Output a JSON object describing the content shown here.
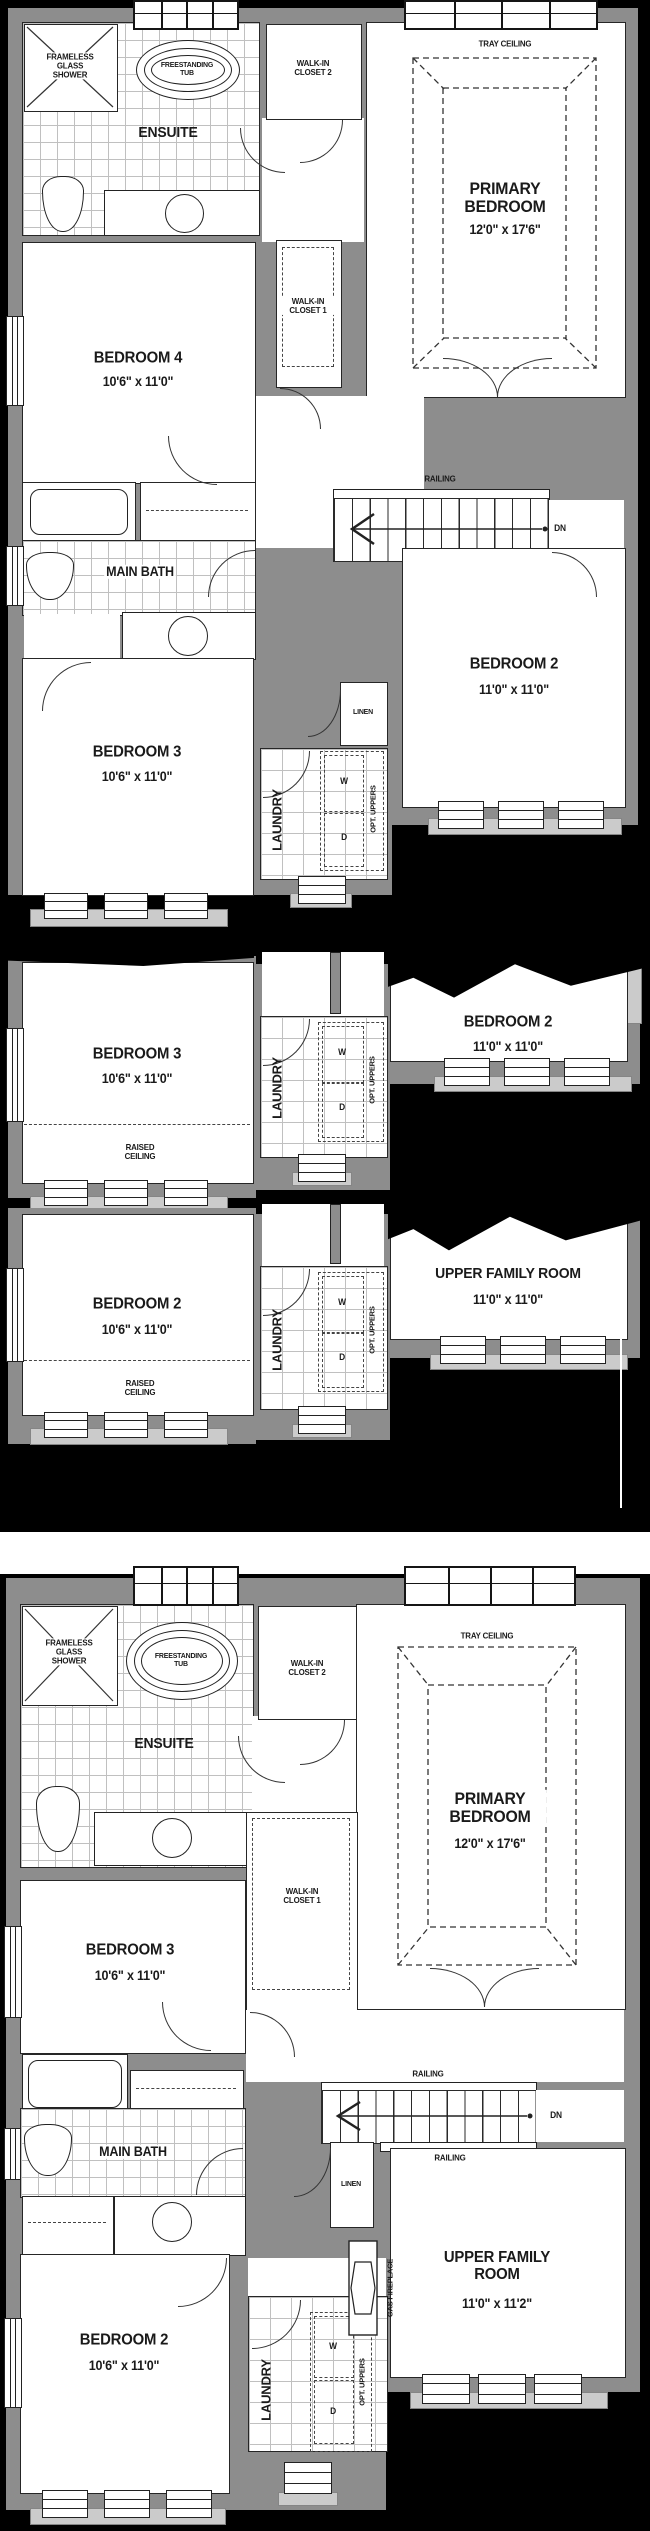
{
  "colors": {
    "background": "#000000",
    "wall": "#8d8d8d",
    "sill": "#cbcbcb",
    "floor": "#ffffff",
    "line": "#262626"
  },
  "plans": {
    "p1": {
      "ensuite": "ENSUITE",
      "shower": "FRAMELESS GLASS SHOWER",
      "tub": "FREESTANDING TUB",
      "wic2": "WALK-IN CLOSET 2",
      "wic1": "WALK-IN CLOSET 1",
      "tray": "TRAY CEILING",
      "primary": "PRIMARY BEDROOM",
      "primary_dim": "12'0\" x 17'6\"",
      "bed4": "BEDROOM 4",
      "bed4_dim": "10'6\" x 11'0\"",
      "main_bath": "MAIN BATH",
      "railing": "RAILING",
      "dn": "DN",
      "bed2": "BEDROOM 2",
      "bed2_dim": "11'0\" x 11'0\"",
      "bed3": "BEDROOM 3",
      "bed3_dim": "10'6\" x 11'0\"",
      "linen": "LINEN",
      "laundry": "LAUNDRY",
      "washer": "W",
      "dryer": "D",
      "opt_uppers": "OPT. UPPERS"
    },
    "p2": {
      "bed3": "BEDROOM 3",
      "bed3_dim": "10'6\" x 11'0\"",
      "raised": "RAISED CEILING",
      "laundry": "LAUNDRY",
      "washer": "W",
      "dryer": "D",
      "opt_uppers": "OPT. UPPERS",
      "bed2": "BEDROOM 2",
      "bed2_dim": "11'0\" x 11'0\""
    },
    "p3": {
      "bed2": "BEDROOM 2",
      "bed2_dim": "10'6\" x 11'0\"",
      "raised": "RAISED CEILING",
      "laundry": "LAUNDRY",
      "washer": "W",
      "dryer": "D",
      "opt_uppers": "OPT. UPPERS",
      "ufr": "UPPER FAMILY ROOM",
      "ufr_dim": "11'0\" x 11'0\""
    },
    "p4": {
      "ensuite": "ENSUITE",
      "shower": "FRAMELESS GLASS SHOWER",
      "tub": "FREESTANDING TUB",
      "wic2": "WALK-IN CLOSET 2",
      "wic1": "WALK-IN CLOSET 1",
      "tray": "TRAY CEILING",
      "primary": "PRIMARY BEDROOM",
      "primary_dim": "12'0\" x 17'6\"",
      "bed3": "BEDROOM 3",
      "bed3_dim": "10'6\" x 11'0\"",
      "main_bath": "MAIN BATH",
      "railing_top": "RAILING",
      "railing_bottom": "RAILING",
      "dn": "DN",
      "linen": "LINEN",
      "gas_fireplace": "GAS FIREPLACE",
      "ufr": "UPPER FAMILY ROOM",
      "ufr_dim": "11'0\" x 11'2\"",
      "bed2": "BEDROOM 2",
      "bed2_dim": "10'6\" x 11'0\"",
      "laundry": "LAUNDRY",
      "washer": "W",
      "dryer": "D",
      "opt_uppers": "OPT. UPPERS"
    }
  }
}
